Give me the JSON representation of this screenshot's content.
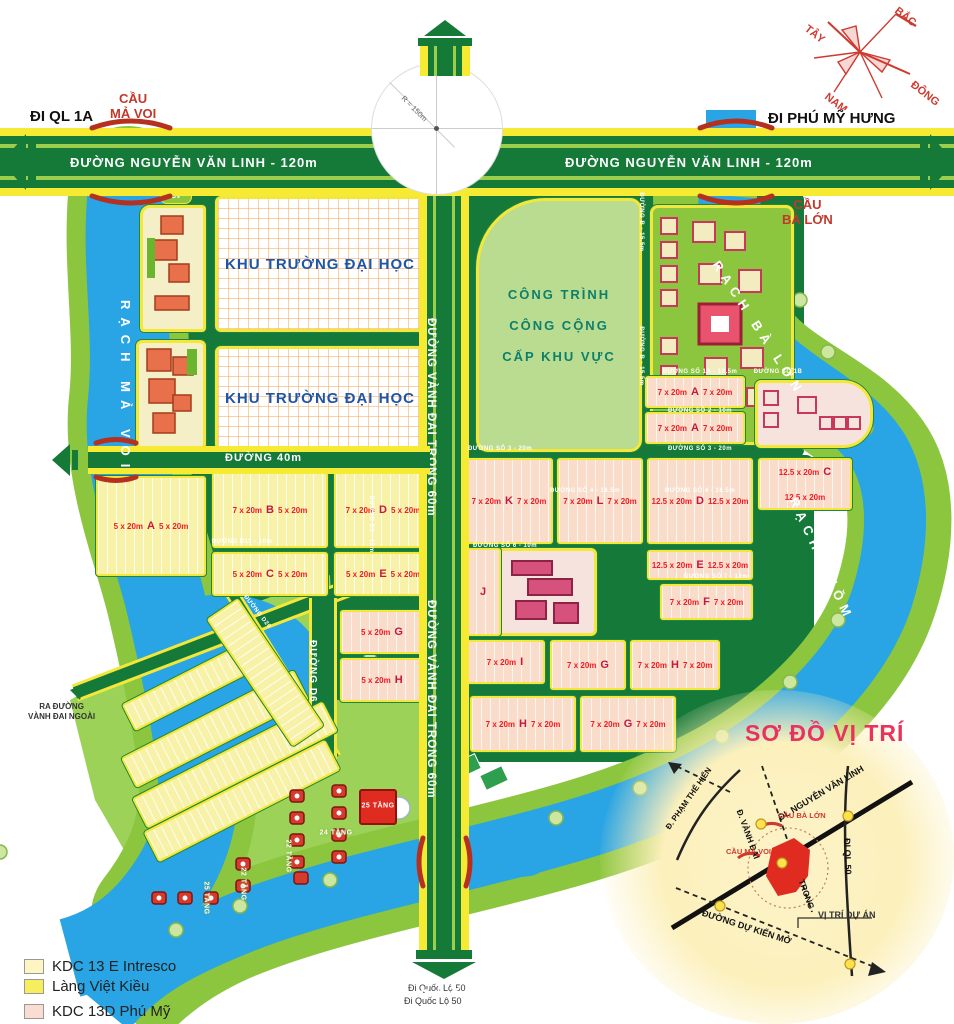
{
  "compass": {
    "north": "BẮC",
    "south": "NAM",
    "east": "ĐÔNG",
    "west": "TÂY"
  },
  "main_roads": {
    "nguyen_van_linh": "ĐƯỜNG NGUYỄN VĂN LINH - 120m",
    "vanh_dai_trong": "ĐƯỜNG VÀNH ĐAI TRONG 60m",
    "duong_40m": "ĐƯỜNG 40m",
    "duong_d6": "ĐƯỜNG D6"
  },
  "directions": {
    "di_ql_1a": "ĐI QL 1A",
    "di_phu_my_hung": "ĐI PHÚ MỸ HƯNG",
    "di_quoc_lo_50_a": "Đi Quốc Lộ  50",
    "di_quoc_lo_50_b": "Đi Quốc Lộ  50",
    "ra_duong_line1": "RA ĐƯỜNG",
    "ra_duong_line2": "VÀNH ĐAI NGOÀI"
  },
  "bridges": {
    "cau_ma_voi_l1": "CẦU",
    "cau_ma_voi_l2": "MẢ VOI",
    "cau_ba_lon_l1": "CẦU",
    "cau_ba_lon_l2": "BÀ LỚN"
  },
  "rivers": {
    "rach_ma_voi": "RẠCH  MẢ  VOI",
    "rach_ba_lon": "RẠCH  BÀ  LỚN",
    "rach_chom": "RẠCH  CHỒM",
    "rach": "RẠCH",
    "chom": "CHỒM"
  },
  "areas": {
    "university": "KHU TRƯỜNG ĐẠI HỌC",
    "public_l1": "CÔNG TRÌNH",
    "public_l2": "CÔNG CỘNG",
    "public_l3": "CẤP KHU VỰC",
    "cv": "CV",
    "roundabout_radius": "R = 150m"
  },
  "legend": {
    "items": [
      {
        "color": "#fdf5c2",
        "label": "KDC 13 E Intresco"
      },
      {
        "color": "#f6ee5d",
        "label": "Làng Việt Kiều"
      },
      {
        "color": "#f9dcd2",
        "label": "KDC 13D Phú Mỹ"
      }
    ]
  },
  "inset": {
    "title": "SƠ ĐỒ VỊ TRÍ",
    "nvl": "ĐL NGUYỄN VĂN LINH",
    "pth": "Đ. PHẠM THẾ HIỂN",
    "vanh_dai": "Đ. VÀNH ĐAI",
    "trong": "TRONG",
    "ql50": "ĐI QL 50",
    "du_kien": "ĐƯỜNG DỰ KIẾN MỞ",
    "vi_tri": "VỊ TRÍ DỰ ÁN",
    "cau_ba_lon": "CẦU BÀ LỚN",
    "cau_ma_voi": "CẦU MẢ VOI"
  },
  "parcels": [
    {
      "x": 96,
      "y": 476,
      "w": 110,
      "h": 100,
      "c": "y",
      "letter": "A",
      "s": "5 x 20m"
    },
    {
      "x": 212,
      "y": 472,
      "w": 116,
      "h": 76,
      "c": "y",
      "letter": "B",
      "s": "7 x 20m",
      "s2": "5 x 20m"
    },
    {
      "x": 212,
      "y": 552,
      "w": 116,
      "h": 44,
      "c": "y",
      "letter": "C",
      "s": "5 x 20m",
      "s2": "5 x 20m"
    },
    {
      "x": 334,
      "y": 472,
      "w": 98,
      "h": 76,
      "c": "y",
      "letter": "D",
      "s": "7 x 20m",
      "s2": "5 x 20m"
    },
    {
      "x": 334,
      "y": 552,
      "w": 98,
      "h": 44,
      "c": "y",
      "letter": "E",
      "s": "5 x 20m"
    },
    {
      "x": 645,
      "y": 376,
      "w": 100,
      "h": 32,
      "c": "p",
      "letter": "A",
      "s": "7 x 20m",
      "s2": "7 x 20m"
    },
    {
      "x": 645,
      "y": 412,
      "w": 100,
      "h": 32,
      "c": "p",
      "letter": "A",
      "s": "7 x 20m",
      "s2": "7 x 20m"
    },
    {
      "x": 465,
      "y": 458,
      "w": 88,
      "h": 86,
      "c": "p",
      "letter": "K",
      "s": "7 x 20m"
    },
    {
      "x": 557,
      "y": 458,
      "w": 86,
      "h": 86,
      "c": "p",
      "letter": "L",
      "s": "7 x 20m",
      "s2": "7 x 20m"
    },
    {
      "x": 647,
      "y": 458,
      "w": 106,
      "h": 86,
      "c": "p",
      "letter": "D",
      "s": "12.5 x 20m",
      "s2": "12.5 x 20m"
    },
    {
      "x": 758,
      "y": 458,
      "w": 94,
      "h": 52,
      "c": "p",
      "letter": "C",
      "s": "12.5 x 20m"
    },
    {
      "x": 647,
      "y": 550,
      "w": 106,
      "h": 30,
      "c": "p",
      "letter": "E",
      "s": "12.5 x 20m",
      "s2": "12.5 x 20m"
    },
    {
      "x": 660,
      "y": 584,
      "w": 93,
      "h": 36,
      "c": "p",
      "letter": "F",
      "s": "7 x 20m"
    },
    {
      "x": 465,
      "y": 548,
      "w": 36,
      "h": 88,
      "c": "p",
      "letter": "J"
    },
    {
      "x": 465,
      "y": 640,
      "w": 80,
      "h": 44,
      "c": "p",
      "letter": "I",
      "s": "7 x 20m"
    },
    {
      "x": 550,
      "y": 640,
      "w": 76,
      "h": 50,
      "c": "p",
      "letter": "G",
      "s": "7 x 20m"
    },
    {
      "x": 630,
      "y": 640,
      "w": 90,
      "h": 50,
      "c": "p",
      "letter": "H",
      "s": "7 x 20m"
    },
    {
      "x": 340,
      "y": 610,
      "w": 84,
      "h": 44,
      "c": "p",
      "letter": "G",
      "s": "5 x 20m"
    },
    {
      "x": 340,
      "y": 658,
      "w": 84,
      "h": 44,
      "c": "p",
      "letter": "H",
      "s": "5 x 20m"
    },
    {
      "x": 470,
      "y": 696,
      "w": 106,
      "h": 56,
      "c": "p",
      "letter": "H",
      "s": "7 x 20m"
    },
    {
      "x": 580,
      "y": 696,
      "w": 96,
      "h": 56,
      "c": "p",
      "letter": "G",
      "s": "7 x 20m"
    }
  ],
  "road_labels": [
    {
      "text": "ĐƯỜNG SỐ 3 - 20m",
      "x": 500,
      "y": 449,
      "r": 0
    },
    {
      "text": "ĐƯỜNG SỐ 3 - 20m",
      "x": 700,
      "y": 449,
      "r": 0
    },
    {
      "text": "ĐƯỜNG SỐ 4 - 16.5m",
      "x": 585,
      "y": 491,
      "r": 0
    },
    {
      "text": "ĐƯỜNG SỐ 4 - 16.5m",
      "x": 700,
      "y": 491,
      "r": 0
    },
    {
      "text": "ĐƯỜNG SỐ 1A - 10.5m",
      "x": 700,
      "y": 372,
      "r": 0
    },
    {
      "text": "ĐƯỜNG SỐ 1B",
      "x": 778,
      "y": 372,
      "r": 0
    },
    {
      "text": "ĐƯỜNG SỐ 2 - 10m",
      "x": 700,
      "y": 411,
      "r": 0
    },
    {
      "text": "ĐƯỜNG B - 15.5m",
      "x": 641,
      "y": 222,
      "r": 90
    },
    {
      "text": "ĐƯỜNG B - 15.5m",
      "x": 641,
      "y": 356,
      "r": 90
    },
    {
      "text": "ĐƯỜNG SỐ 6 - 10m",
      "x": 505,
      "y": 546,
      "r": 0
    },
    {
      "text": "ĐƯỜNG SỐ 7 - 12m",
      "x": 716,
      "y": 577,
      "r": 0
    },
    {
      "text": "ĐƯỜNG D11 - 10m",
      "x": 242,
      "y": 542,
      "r": 0
    },
    {
      "text": "ĐƯỜNG D9 - 12m",
      "x": 371,
      "y": 524,
      "r": 90
    },
    {
      "text": "ĐƯỜNG D20",
      "x": 257,
      "y": 612,
      "r": 52
    }
  ],
  "tower_labels": [
    {
      "text": "24 TẦNG",
      "x": 336,
      "y": 833,
      "r": 0,
      "cls": "towerlabel"
    },
    {
      "text": "22 TẦNG",
      "x": 288,
      "y": 856,
      "r": 90,
      "cls": "towerlabel"
    },
    {
      "text": "22 TẦNG",
      "x": 243,
      "y": 884,
      "r": 90,
      "cls": "towerlabel"
    },
    {
      "text": "25 TẦNG",
      "x": 378,
      "y": 806,
      "r": 0,
      "cls": "towerlabel onred"
    },
    {
      "text": "25 TẦNG",
      "x": 206,
      "y": 898,
      "r": 90,
      "cls": "towerlabel"
    }
  ]
}
